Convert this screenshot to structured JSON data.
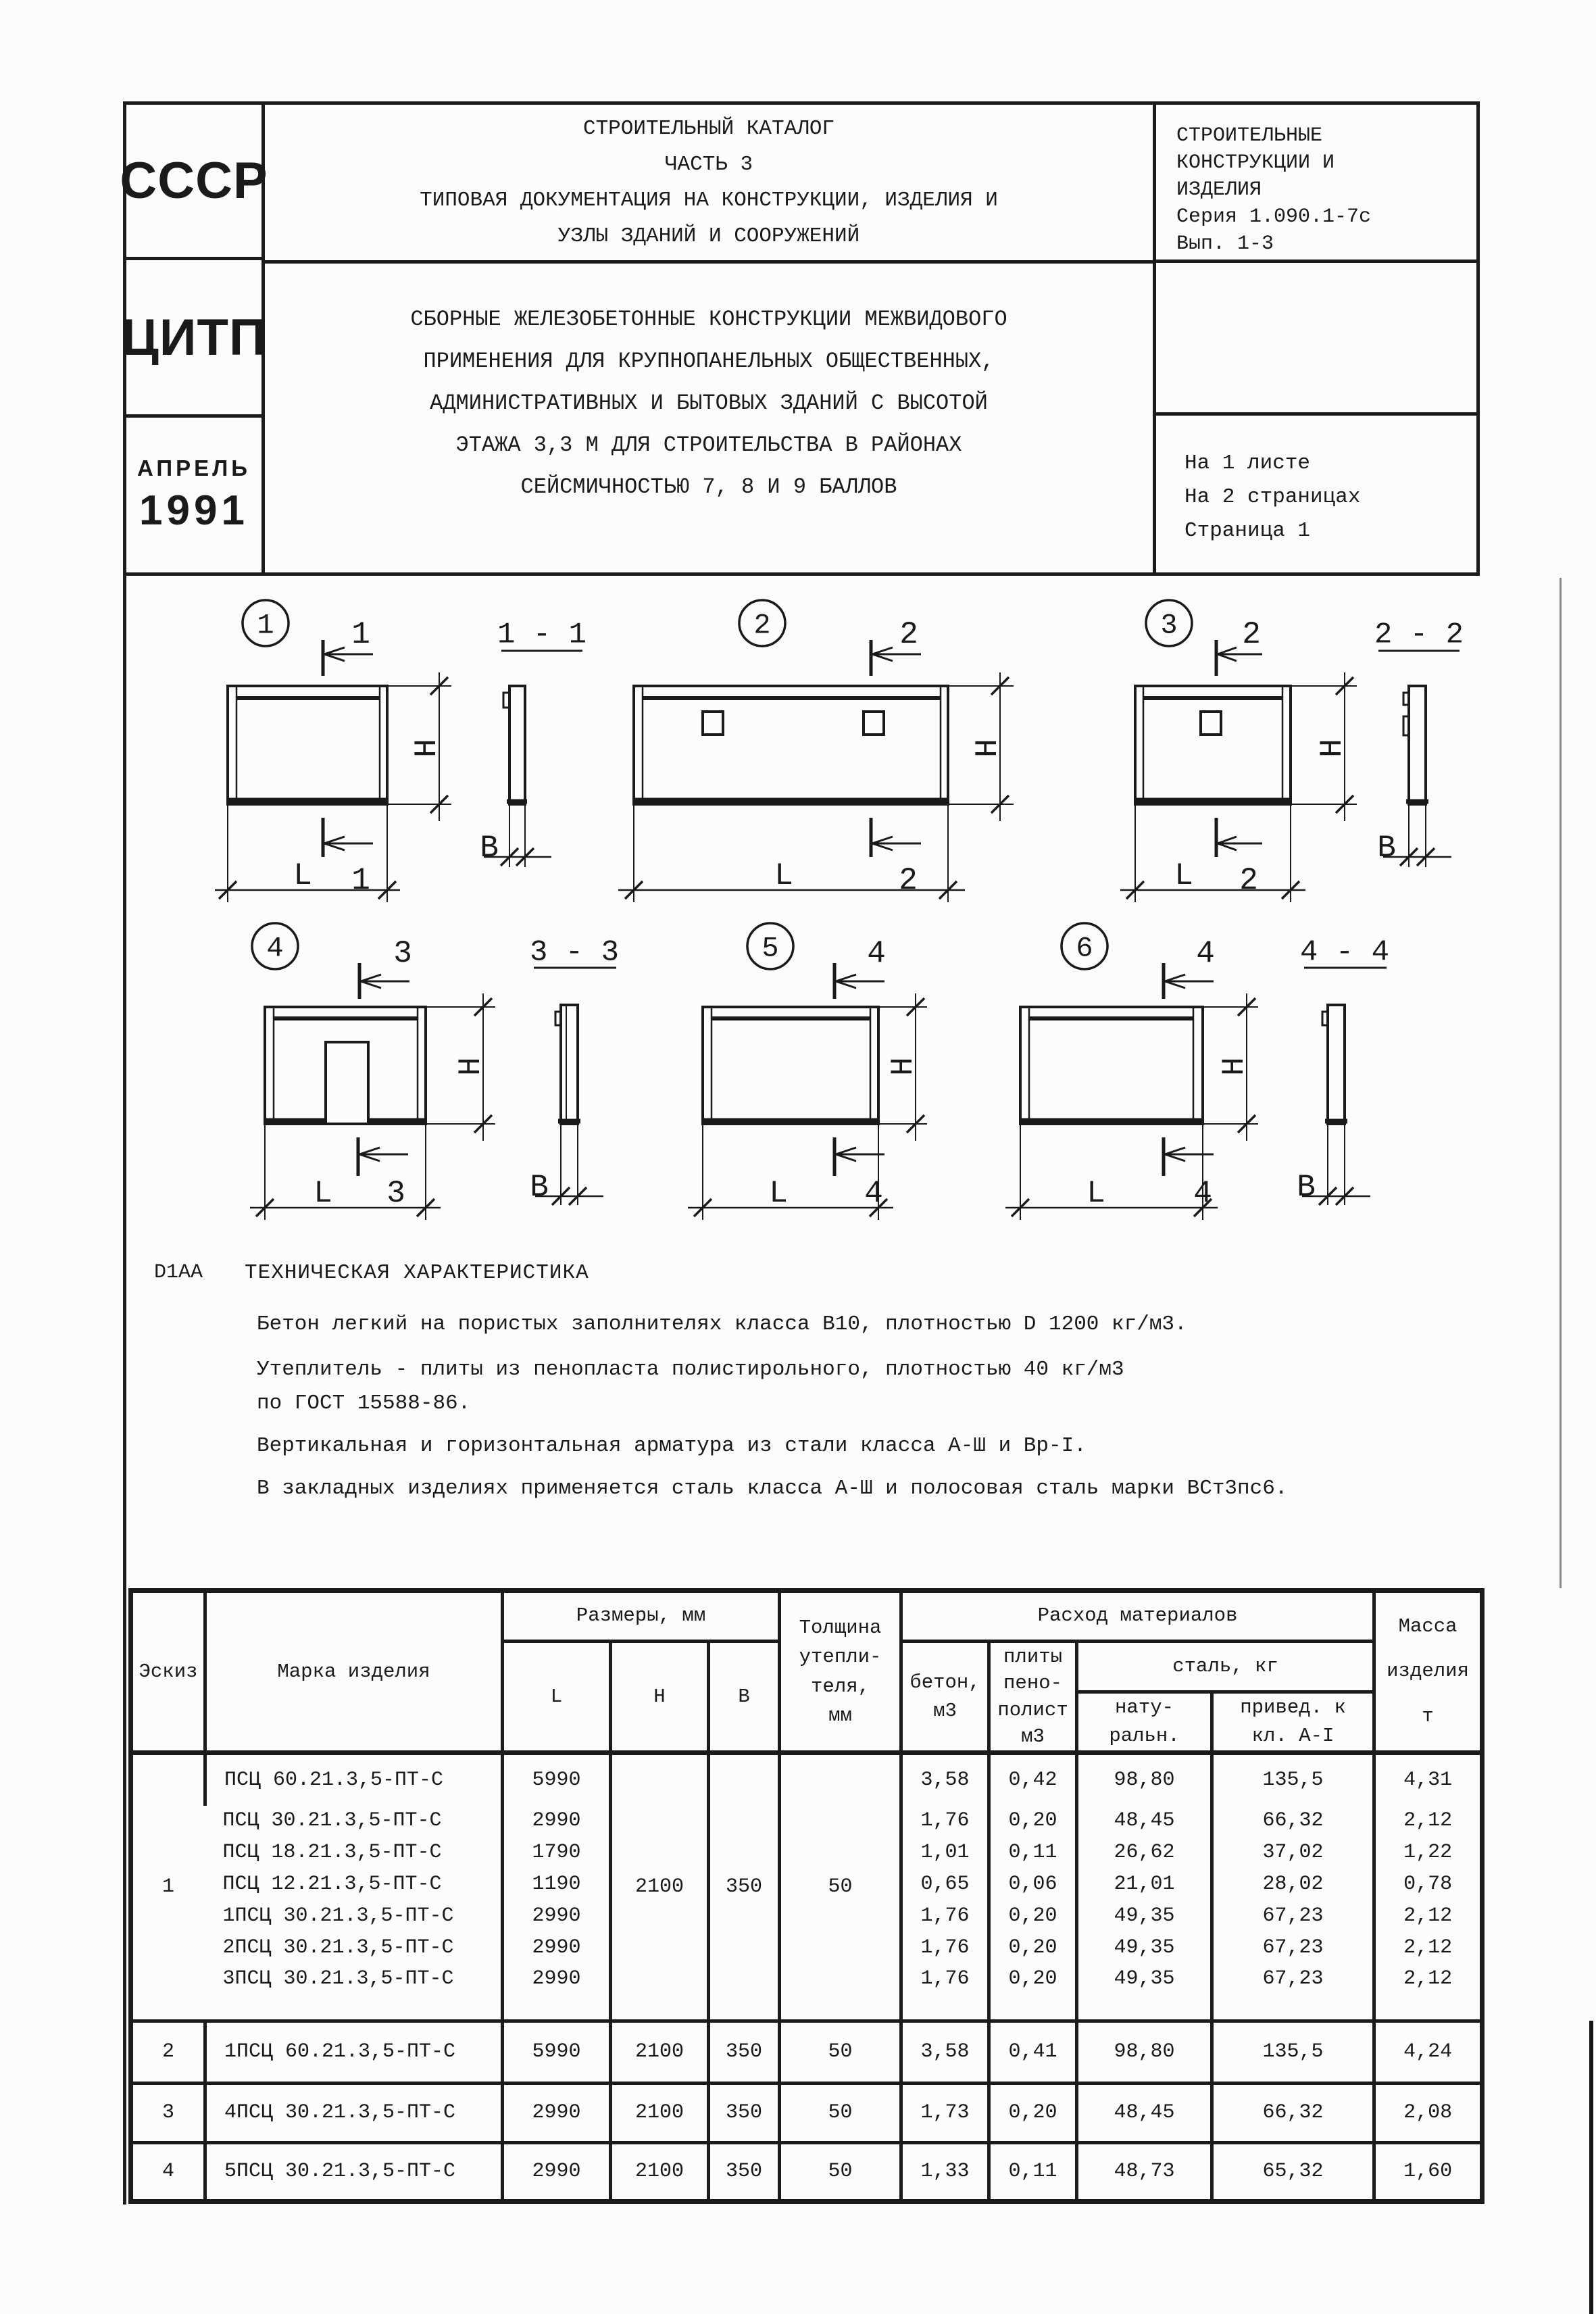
{
  "header": {
    "stamp_country": "СССР",
    "stamp_org": "ЦИТП",
    "stamp_month": "АПРЕЛЬ",
    "stamp_year": "1991",
    "catalog": {
      "line1": "СТРОИТЕЛЬНЫЙ КАТАЛОГ",
      "line2": "ЧАСТЬ 3",
      "line3": "ТИПОВАЯ ДОКУМЕНТАЦИЯ НА КОНСТРУКЦИИ, ИЗДЕЛИЯ И",
      "line4": "УЗЛЫ ЗДАНИЙ И СООРУЖЕНИЙ"
    },
    "subject": {
      "line1": "СБОРНЫЕ ЖЕЛЕЗОБЕТОННЫЕ КОНСТРУКЦИИ МЕЖВИДОВОГО",
      "line2": "ПРИМЕНЕНИЯ ДЛЯ КРУПНОПАНЕЛЬНЫХ ОБЩЕСТВЕННЫХ,",
      "line3": "АДМИНИСТРАТИВНЫХ И БЫТОВЫХ ЗДАНИЙ С ВЫСОТОЙ",
      "line4": "ЭТАЖА 3,3 М ДЛЯ СТРОИТЕЛЬСТВА В РАЙОНАХ",
      "line5": "СЕЙСМИЧНОСТЬЮ 7, 8 И 9 БАЛЛОВ"
    },
    "series": {
      "line1": "СТРОИТЕЛЬНЫЕ",
      "line2": "КОНСТРУКЦИИ И",
      "line3": "ИЗДЕЛИЯ",
      "line4": "Серия 1.090.1-7с",
      "line5": "Вып. 1-3"
    },
    "sheet_info": {
      "line1": "На 1 листе",
      "line2": "На 2 страницах",
      "line3": "Страница 1"
    }
  },
  "drawings": {
    "dim_l": "L",
    "dim_h": "H",
    "dim_b": "B",
    "sketches": [
      {
        "no": "1",
        "cut": "1"
      },
      {
        "no": "2",
        "cut": "2"
      },
      {
        "no": "3",
        "cut": "2"
      },
      {
        "no": "4",
        "cut": "3"
      },
      {
        "no": "5",
        "cut": "4"
      },
      {
        "no": "6",
        "cut": "4"
      }
    ],
    "sections": [
      "1 - 1",
      "2 - 2",
      "3 - 3",
      "4 - 4"
    ]
  },
  "tech": {
    "code": "D1AA",
    "heading": "ТЕХНИЧЕСКАЯ ХАРАКТЕРИСТИКА",
    "p1": "Бетон легкий на пористых заполнителях класса В10, плотностью D 1200 кг/м3.",
    "p2": "Утеплитель - плиты из пенопласта полистирольного, плотностью 40 кг/м3",
    "p3": "по ГОСТ 15588-86.",
    "p4": "Вертикальная и горизонтальная арматура из стали класса А-Ш и Вр-I.",
    "p5": "В закладных изделиях применяется сталь класса А-Ш и полосовая сталь марки ВСт3пс6."
  },
  "table": {
    "columns": {
      "sketch": "Эскиз",
      "mark": "Марка изделия",
      "dims_group": "Размеры, мм",
      "dim_l": "L",
      "dim_h": "H",
      "dim_b": "B",
      "insulation_lines": [
        "Толщина",
        "утепли-",
        "теля,",
        "мм"
      ],
      "materials_group": "Расход материалов",
      "concrete_lines": [
        "бетон,",
        "м3"
      ],
      "foam_lines": [
        "плиты",
        "пено-",
        "полист",
        "м3"
      ],
      "steel_group": "сталь, кг",
      "steel_natural_lines": [
        "нату-",
        "ральн."
      ],
      "steel_reduced_lines": [
        "привед. к",
        "кл. А-I"
      ],
      "mass_lines": [
        "Масса",
        "изделия",
        "т"
      ]
    },
    "group1": {
      "sketch_no": "1",
      "h": "2100",
      "b": "350",
      "ins": "50",
      "rows": [
        {
          "mark": "ПСЦ 60.21.3,5-ПТ-С",
          "l": "5990",
          "concrete": "3,58",
          "foam": "0,42",
          "steel_nat": "98,80",
          "steel_red": "135,5",
          "mass": "4,31"
        },
        {
          "mark": "ПСЦ 30.21.3,5-ПТ-С",
          "l": "2990",
          "concrete": "1,76",
          "foam": "0,20",
          "steel_nat": "48,45",
          "steel_red": "66,32",
          "mass": "2,12"
        },
        {
          "mark": "ПСЦ 18.21.3,5-ПТ-С",
          "l": "1790",
          "concrete": "1,01",
          "foam": "0,11",
          "steel_nat": "26,62",
          "steel_red": "37,02",
          "mass": "1,22"
        },
        {
          "mark": "ПСЦ 12.21.3,5-ПТ-С",
          "l": "1190",
          "concrete": "0,65",
          "foam": "0,06",
          "steel_nat": "21,01",
          "steel_red": "28,02",
          "mass": "0,78"
        },
        {
          "mark": "1ПСЦ 30.21.3,5-ПТ-С",
          "l": "2990",
          "concrete": "1,76",
          "foam": "0,20",
          "steel_nat": "49,35",
          "steel_red": "67,23",
          "mass": "2,12"
        },
        {
          "mark": "2ПСЦ 30.21.3,5-ПТ-С",
          "l": "2990",
          "concrete": "1,76",
          "foam": "0,20",
          "steel_nat": "49,35",
          "steel_red": "67,23",
          "mass": "2,12"
        },
        {
          "mark": "3ПСЦ 30.21.3,5-ПТ-С",
          "l": "2990",
          "concrete": "1,76",
          "foam": "0,20",
          "steel_nat": "49,35",
          "steel_red": "67,23",
          "mass": "2,12"
        }
      ]
    },
    "rows": [
      {
        "sketch_no": "2",
        "mark": "1ПСЦ 60.21.3,5-ПТ-С",
        "l": "5990",
        "h": "2100",
        "b": "350",
        "ins": "50",
        "concrete": "3,58",
        "foam": "0,41",
        "steel_nat": "98,80",
        "steel_red": "135,5",
        "mass": "4,24"
      },
      {
        "sketch_no": "3",
        "mark": "4ПСЦ 30.21.3,5-ПТ-С",
        "l": "2990",
        "h": "2100",
        "b": "350",
        "ins": "50",
        "concrete": "1,73",
        "foam": "0,20",
        "steel_nat": "48,45",
        "steel_red": "66,32",
        "mass": "2,08"
      },
      {
        "sketch_no": "4",
        "mark": "5ПСЦ 30.21.3,5-ПТ-С",
        "l": "2990",
        "h": "2100",
        "b": "350",
        "ins": "50",
        "concrete": "1,33",
        "foam": "0,11",
        "steel_nat": "48,73",
        "steel_red": "65,32",
        "mass": "1,60"
      }
    ]
  }
}
